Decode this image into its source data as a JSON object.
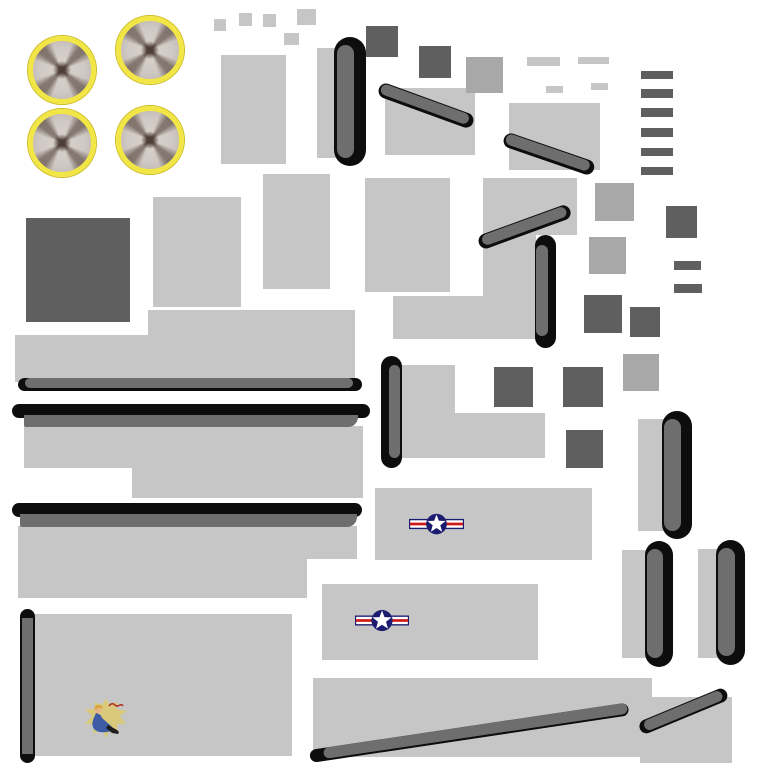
{
  "document": {
    "type": "texture-atlas",
    "subject": "WWII bomber aircraft skin texture sheet (UV atlas)",
    "visible_text": "none (only illegible red nose-art script)"
  },
  "palette": {
    "background": "#ffffff",
    "panel_light": "#c6c6c6",
    "panel_medium": "#a8a8a8",
    "panel_dark": "#5f5f5f",
    "edge_gray": "#6e6e6e",
    "edge_black": "#0d0d0d",
    "prop_ring": "#f2e646",
    "prop_ring_edge": "#cdbc25",
    "prop_disc": "#cfc8c3",
    "prop_blade": "#4c3a31",
    "insignia_navy": "#1b1b70",
    "insignia_red": "#cf1a1a",
    "insignia_white": "#ffffff",
    "art_burst": "#d9c972",
    "art_skin": "#e9b582",
    "art_hair": "#d8a43c",
    "art_outfit": "#3e5ca6",
    "art_boot": "#1e1e1e",
    "art_script": "#b23524"
  },
  "components": {
    "propeller_discs": {
      "count": 4,
      "style": "yellow ring, gray disc, dark blurred X blades, dark hub"
    },
    "insignia": {
      "count": 2,
      "style": "USAF star-and-bars roundel"
    },
    "nose_art": {
      "count": 1,
      "style": "pin-up girl in blue on yellow starburst with red script"
    },
    "light_panels": {
      "count": 35
    },
    "medium_panels": {
      "count": 4
    },
    "dark_panels_and_slats": {
      "count": 17
    },
    "black_edge_strips": {
      "count": 15
    }
  }
}
